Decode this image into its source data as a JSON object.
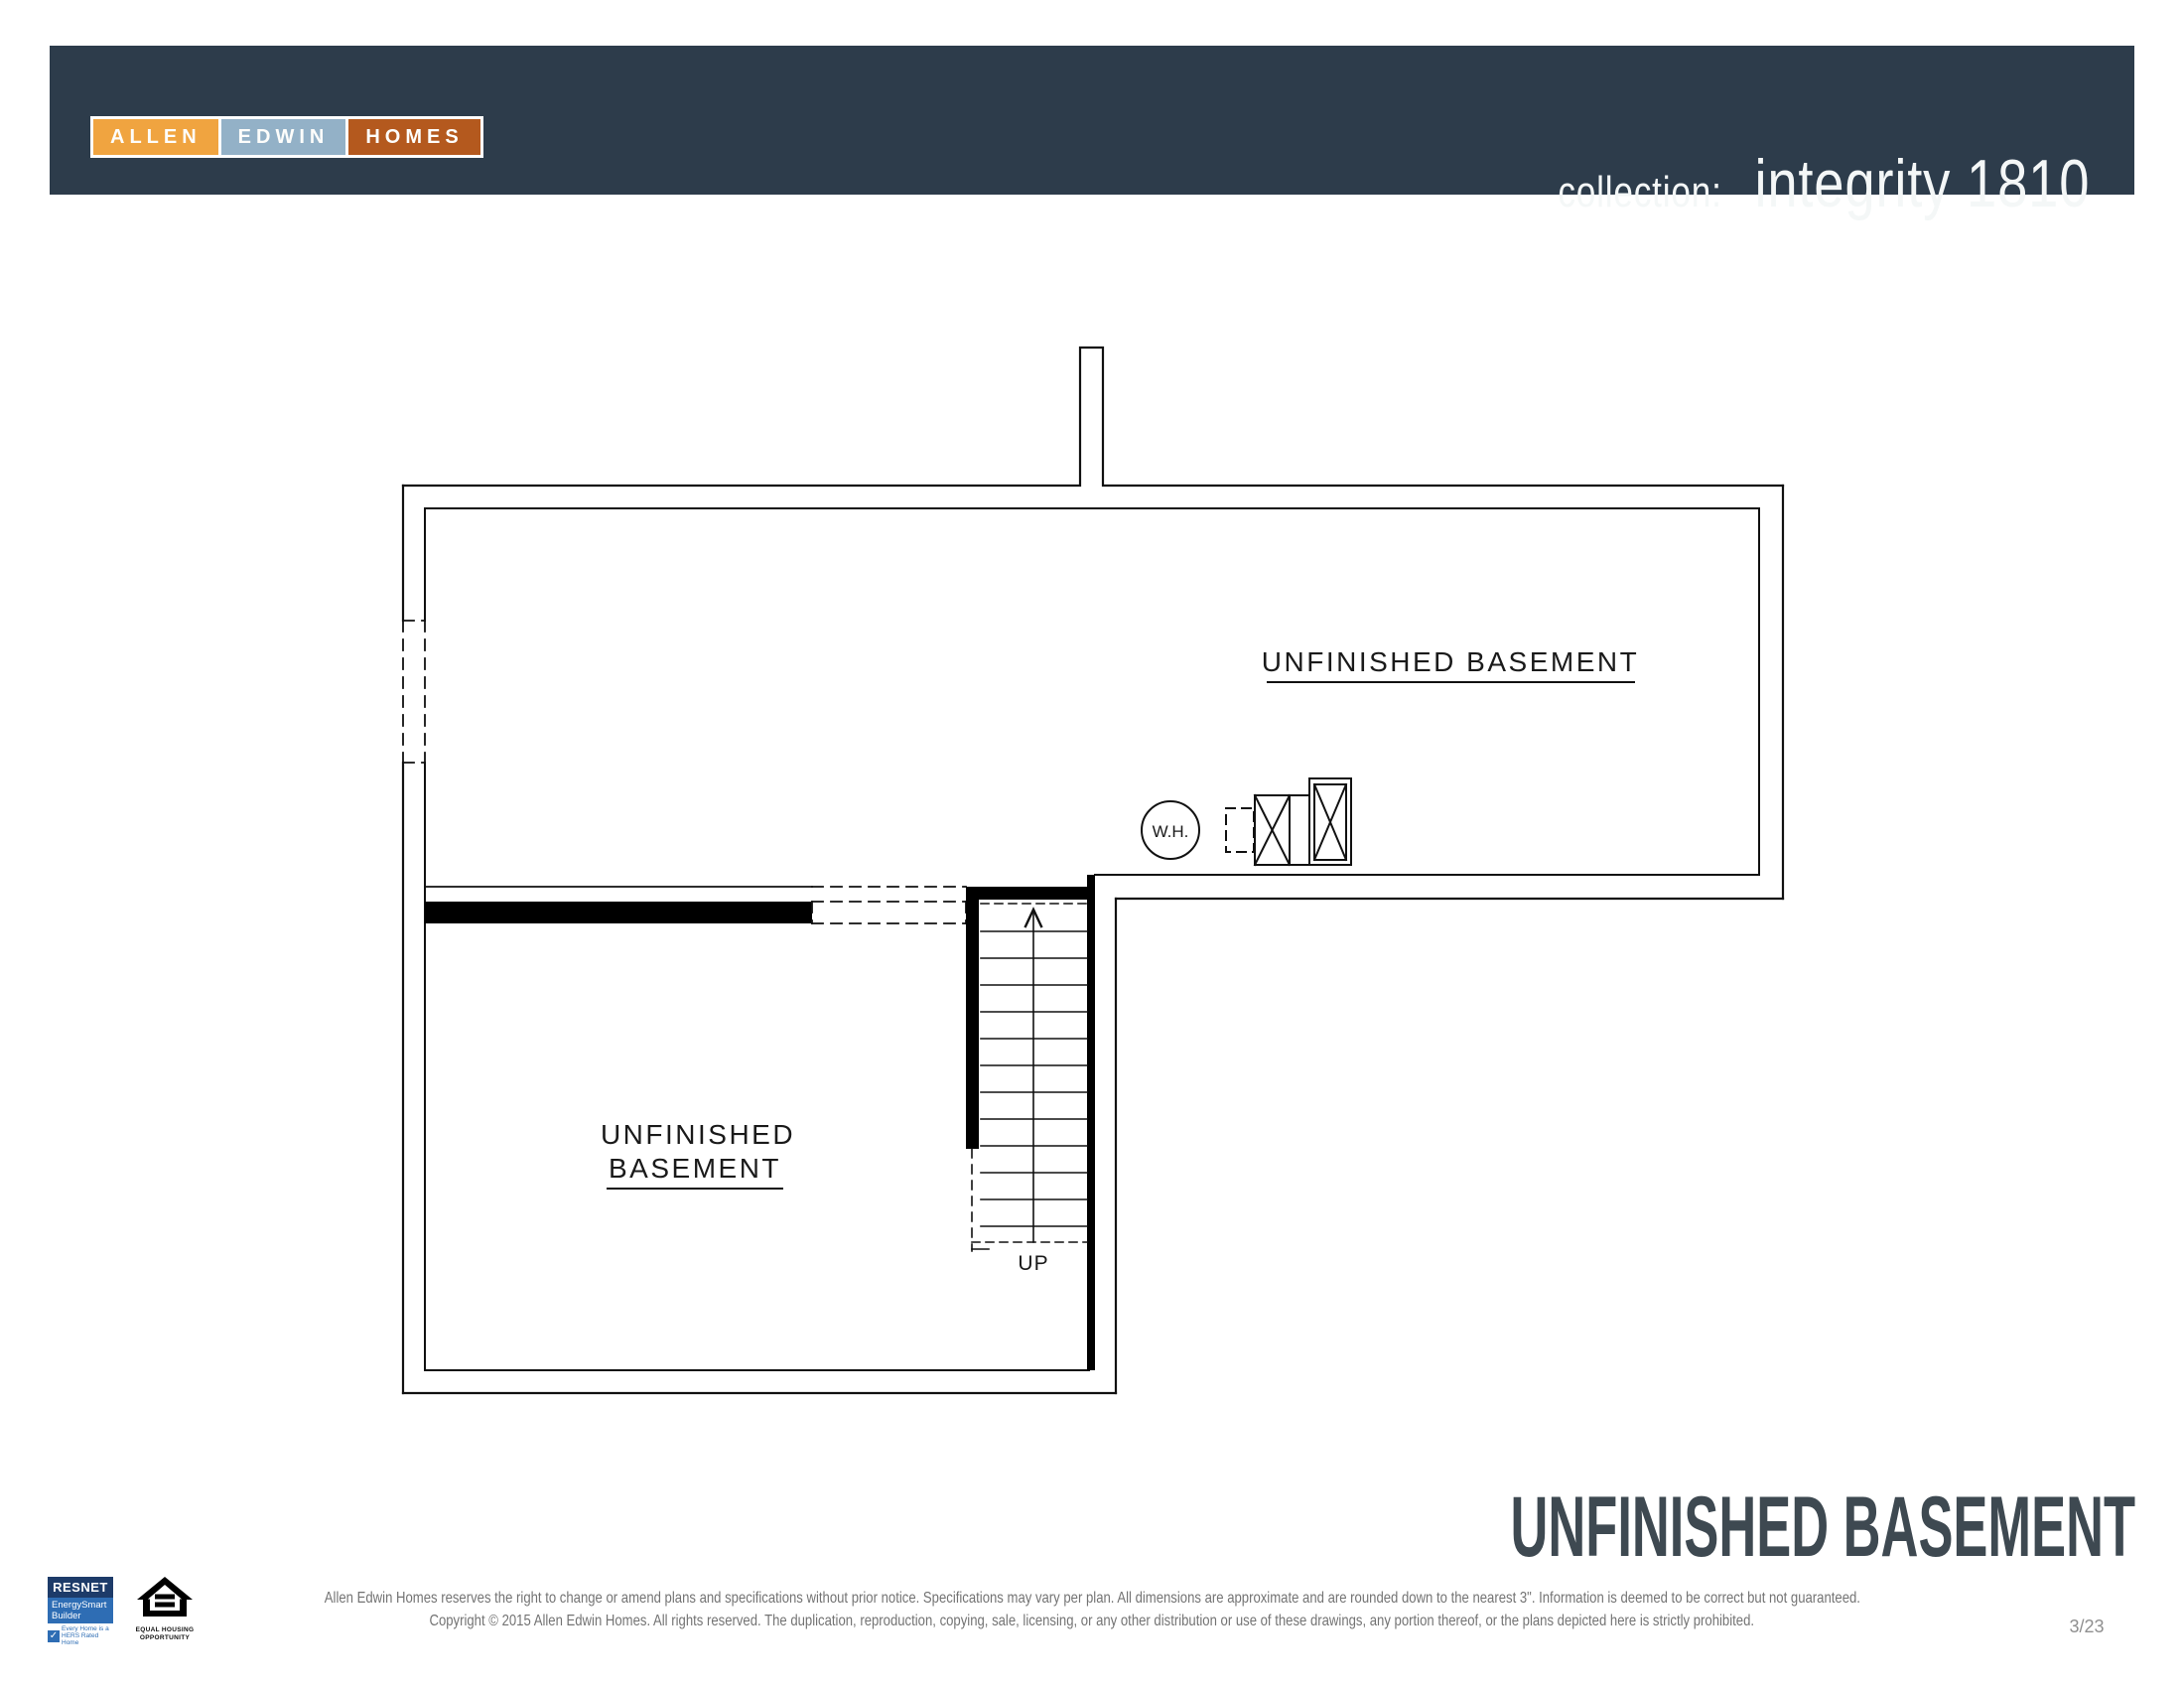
{
  "header": {
    "logo": {
      "word1": "ALLEN",
      "word2": "EDWIN",
      "word3": "HOMES"
    },
    "collection_label": "collection:",
    "plan_name": "integrity 1810"
  },
  "colors": {
    "header_bar": "#2d3c4b",
    "logo_allen": "#f0a440",
    "logo_edwin": "#93b1c7",
    "logo_homes": "#b4591e",
    "footer_title": "#3e4951",
    "resnet_navy": "#1d3b69",
    "resnet_blue": "#2e6db4",
    "line_color": "#111111"
  },
  "plan": {
    "labels": {
      "main_area": "UNFINISHED BASEMENT",
      "lower_area_line1": "UNFINISHED",
      "lower_area_line2": "BASEMENT",
      "water_heater": "W.H.",
      "stairs_direction": "UP"
    }
  },
  "footer": {
    "title": "UNFINISHED BASEMENT",
    "disclaimer_line1": "Allen Edwin Homes reserves the right to change or amend plans and specifications without prior notice. Specifications may vary per plan. All dimensions are approximate and are rounded down to the nearest 3\". Information is deemed to be correct but not guaranteed.",
    "disclaimer_line2": "Copyright © 2015 Allen Edwin Homes. All rights reserved. The duplication, reproduction, copying, sale, licensing, or any other distribution or use of these drawings, any portion thereof, or the plans depicted here is strictly prohibited.",
    "page_number": "3/23",
    "resnet": {
      "brand": "RESNET",
      "program_line1": "EnergySmart",
      "program_line2": "Builder",
      "check": "✓",
      "tagline_line1": "Every Home is a",
      "tagline_line2": "HERS Rated Home"
    },
    "equal_housing": {
      "line1": "EQUAL HOUSING",
      "line2": "OPPORTUNITY"
    }
  }
}
